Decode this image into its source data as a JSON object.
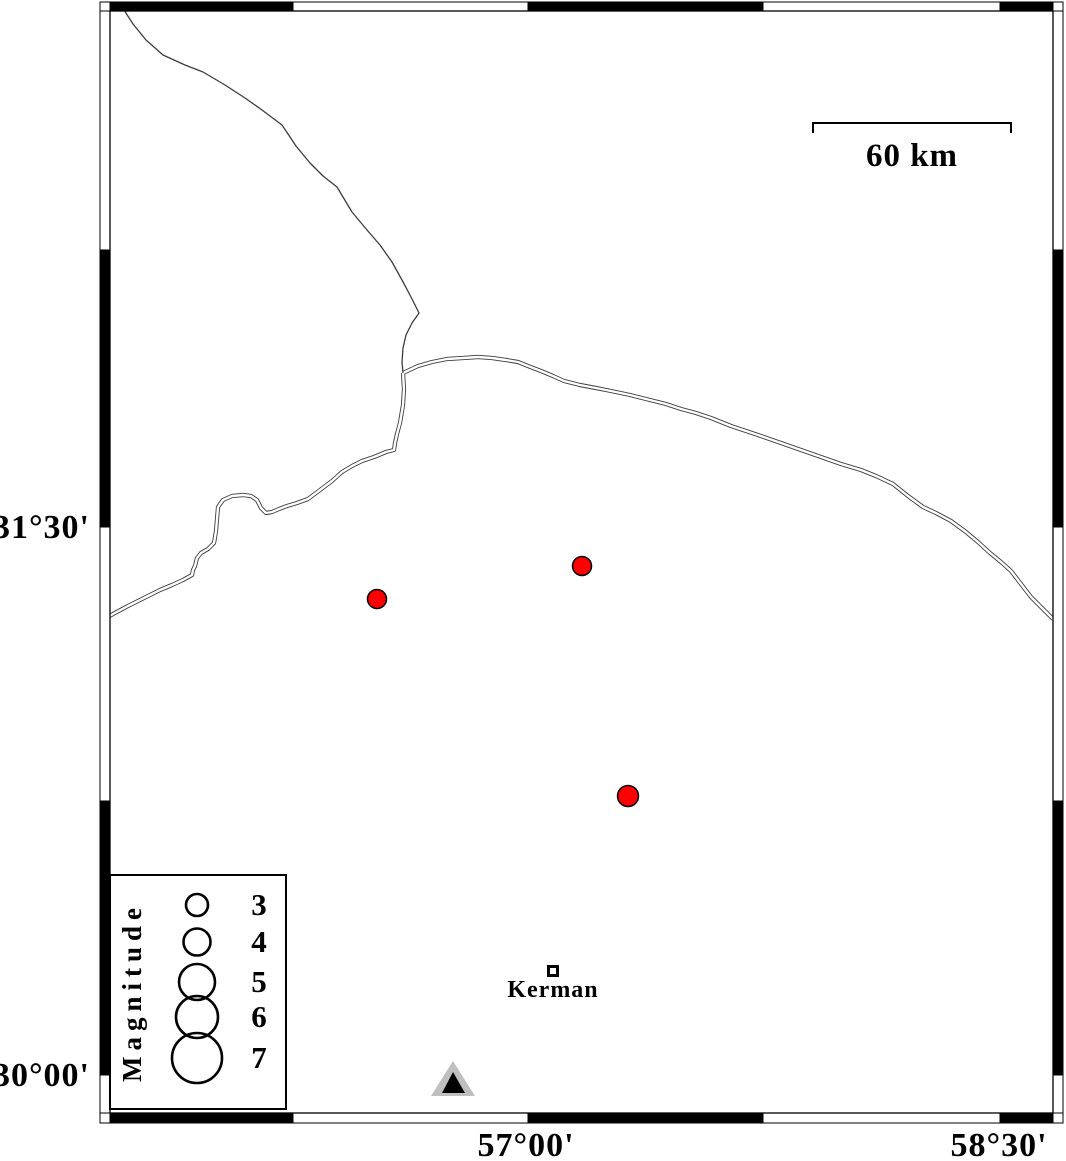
{
  "figure": {
    "kind": "earthquake-seismicity-map",
    "background": "#ffffff"
  },
  "frame": {
    "inner": {
      "x1": 110,
      "y1": 11,
      "x2": 1053,
      "y2": 1113
    },
    "outer": {
      "x1": 100,
      "y1": 2,
      "x2": 1063,
      "y2": 1123
    },
    "horizontal_cells": {
      "edges": [
        100,
        110,
        293,
        528,
        763,
        1000,
        1053,
        1063
      ],
      "fills": [
        "#ffffff",
        "#000000",
        "#ffffff",
        "#000000",
        "#ffffff",
        "#000000",
        "#ffffff"
      ]
    },
    "vertical_cells": {
      "edges": [
        11,
        250,
        527,
        801,
        1075,
        1113
      ],
      "fills": [
        "#ffffff",
        "#000000",
        "#ffffff",
        "#000000",
        "#ffffff"
      ]
    }
  },
  "axes": {
    "left_labels": [
      {
        "text": "31°30'",
        "y": 527
      },
      {
        "text": "30°00'",
        "y": 1075
      }
    ],
    "bottom_labels": [
      {
        "text": "57°00'",
        "x": 526
      },
      {
        "text": "58°30'",
        "x": 999
      }
    ]
  },
  "scalebar": {
    "label": "60 km",
    "x1": 813,
    "x2": 1011,
    "y": 123,
    "tick": 10,
    "label_x": 912,
    "label_y": 166
  },
  "legend": {
    "box": {
      "x": 110,
      "y": 875,
      "w": 176,
      "h": 234
    },
    "title": "Magnitude",
    "title_x": 141,
    "title_y": 992,
    "circle_cx": 197,
    "label_cx": 259,
    "entries": [
      {
        "label": "3",
        "cy": 905,
        "r": 11
      },
      {
        "label": "4",
        "cy": 942,
        "r": 13.5
      },
      {
        "label": "5",
        "cy": 982,
        "r": 18
      },
      {
        "label": "6",
        "cy": 1017,
        "r": 21
      },
      {
        "label": "7",
        "cy": 1058,
        "r": 25
      }
    ]
  },
  "city": {
    "label": "Kerman",
    "x": 553,
    "y": 971,
    "size": 9,
    "stroke": 3,
    "label_x": 553,
    "label_y": 997
  },
  "station": {
    "outer_points": "431,1096 475,1096 453,1061",
    "inner_points": "442,1093 465,1093 453,1072",
    "outer_color": "#bfbfbf",
    "inner_color": "#000000"
  },
  "earthquakes": {
    "color": "#ff0000",
    "points": [
      {
        "x": 377,
        "y": 599,
        "r": 9.5
      },
      {
        "x": 582,
        "y": 566,
        "r": 9.5
      },
      {
        "x": 628,
        "y": 796,
        "r": 10.5
      }
    ]
  },
  "faults": {
    "color": "#3c3c3c",
    "single_lines": [
      [
        [
          124,
          10
        ],
        [
          133,
          24
        ],
        [
          146,
          40
        ],
        [
          163,
          55
        ],
        [
          185,
          65
        ],
        [
          203,
          72
        ],
        [
          225,
          85
        ],
        [
          245,
          98
        ],
        [
          262,
          110
        ],
        [
          282,
          125
        ],
        [
          296,
          146
        ],
        [
          310,
          163
        ],
        [
          323,
          176
        ],
        [
          337,
          187
        ],
        [
          352,
          212
        ],
        [
          367,
          230
        ],
        [
          380,
          245
        ],
        [
          392,
          262
        ],
        [
          402,
          280
        ],
        [
          411,
          297
        ],
        [
          419,
          313
        ],
        [
          412,
          323
        ],
        [
          406,
          335
        ],
        [
          403,
          348
        ],
        [
          402,
          362
        ],
        [
          403,
          373
        ]
      ]
    ],
    "double_lines": [
      [
        [
          403,
          373
        ],
        [
          404,
          389
        ],
        [
          403,
          405
        ],
        [
          400,
          423
        ],
        [
          397,
          434
        ],
        [
          395,
          443
        ],
        [
          394,
          450
        ],
        [
          386,
          452
        ],
        [
          374,
          457
        ],
        [
          362,
          461
        ],
        [
          352,
          466
        ],
        [
          342,
          472
        ],
        [
          332,
          481
        ],
        [
          320,
          490
        ],
        [
          308,
          499
        ],
        [
          297,
          503
        ],
        [
          287,
          506
        ],
        [
          279,
          509
        ],
        [
          272,
          512
        ],
        [
          266,
          513
        ],
        [
          261,
          508
        ],
        [
          257,
          500
        ],
        [
          251,
          496
        ],
        [
          243,
          495
        ],
        [
          232,
          496
        ],
        [
          223,
          500
        ],
        [
          218,
          507
        ],
        [
          217,
          519
        ],
        [
          216,
          531
        ],
        [
          214,
          543
        ],
        [
          208,
          549
        ],
        [
          201,
          553
        ],
        [
          197,
          558
        ],
        [
          195,
          566
        ],
        [
          193,
          570
        ],
        [
          192,
          575
        ],
        [
          183,
          580
        ],
        [
          172,
          585
        ],
        [
          160,
          590
        ],
        [
          144,
          598
        ],
        [
          128,
          606
        ],
        [
          113,
          614
        ],
        [
          108,
          617
        ]
      ],
      [
        [
          403,
          373
        ],
        [
          418,
          366
        ],
        [
          432,
          362
        ],
        [
          447,
          359
        ],
        [
          463,
          358
        ],
        [
          478,
          357
        ],
        [
          492,
          358
        ],
        [
          506,
          360
        ],
        [
          518,
          362
        ],
        [
          528,
          366
        ],
        [
          541,
          371
        ],
        [
          553,
          376
        ],
        [
          564,
          381
        ],
        [
          580,
          385
        ],
        [
          596,
          388
        ],
        [
          611,
          391
        ],
        [
          630,
          395
        ],
        [
          650,
          400
        ],
        [
          666,
          404
        ],
        [
          681,
          409
        ],
        [
          696,
          413
        ],
        [
          711,
          418
        ],
        [
          731,
          426
        ],
        [
          746,
          431
        ],
        [
          761,
          436
        ],
        [
          781,
          443
        ],
        [
          801,
          450
        ],
        [
          821,
          457
        ],
        [
          841,
          464
        ],
        [
          861,
          470
        ],
        [
          876,
          476
        ],
        [
          893,
          484
        ],
        [
          908,
          496
        ],
        [
          923,
          507
        ],
        [
          936,
          513
        ],
        [
          951,
          521
        ],
        [
          966,
          532
        ],
        [
          978,
          542
        ],
        [
          990,
          553
        ],
        [
          1001,
          562
        ],
        [
          1011,
          571
        ],
        [
          1021,
          584
        ],
        [
          1031,
          597
        ],
        [
          1041,
          607
        ],
        [
          1053,
          619
        ]
      ]
    ]
  }
}
